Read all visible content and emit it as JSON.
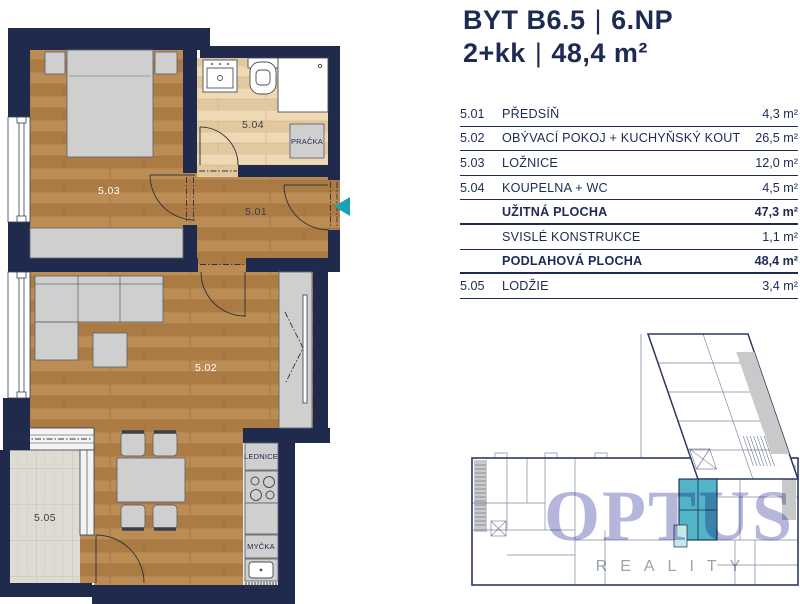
{
  "title": {
    "line1_left": "BYT B6.5",
    "line1_right": "6.NP",
    "line2_left": "2+kk",
    "line2_right": "48,4 m²",
    "separator": "|"
  },
  "table": {
    "rows": [
      {
        "code": "5.01",
        "name": "PŘEDSÍŇ",
        "value": "4,3 m²",
        "bold": false
      },
      {
        "code": "5.02",
        "name": "OBÝVACÍ POKOJ + KUCHYŇSKÝ KOUT",
        "value": "26,5 m²",
        "bold": false
      },
      {
        "code": "5.03",
        "name": "LOŽNICE",
        "value": "12,0 m²",
        "bold": false
      },
      {
        "code": "5.04",
        "name": "KOUPELNA + WC",
        "value": "4,5 m²",
        "bold": false
      },
      {
        "code": "",
        "name": "UŽITNÁ PLOCHA",
        "value": "47,3 m²",
        "bold": true
      },
      {
        "code": "",
        "name": "SVISLÉ KONSTRUKCE",
        "value": "1,1 m²",
        "bold": false
      },
      {
        "code": "",
        "name": "PODLAHOVÁ PLOCHA",
        "value": "48,4 m²",
        "bold": true
      },
      {
        "code": "5.05",
        "name": "LODŽIE",
        "value": "3,4 m²",
        "bold": false
      }
    ]
  },
  "plan": {
    "room_labels": {
      "hall": "5.01",
      "living": "5.02",
      "bedroom": "5.03",
      "bathroom": "5.04",
      "loggia": "5.05"
    },
    "fixtures": {
      "washer": "PRAČKA",
      "fridge": "LEDNICE",
      "dishwasher": "MYČKA"
    }
  },
  "keyplan": {
    "brand": "OPTUS",
    "brand_sub": "REALITY"
  },
  "colors": {
    "navy": "#1f2a4d",
    "entrance_arrow_teal": "#17a2b8",
    "unit_highlight_teal": "#52b4c7",
    "unit_highlight_light": "#c5e8ea",
    "watermark_purple": "#b4b7db",
    "wood": "#b5854c",
    "wood_light": "#e9d3ac",
    "loggia_tile": "#dedbd2",
    "furniture_gray": "#cfcfcf"
  }
}
